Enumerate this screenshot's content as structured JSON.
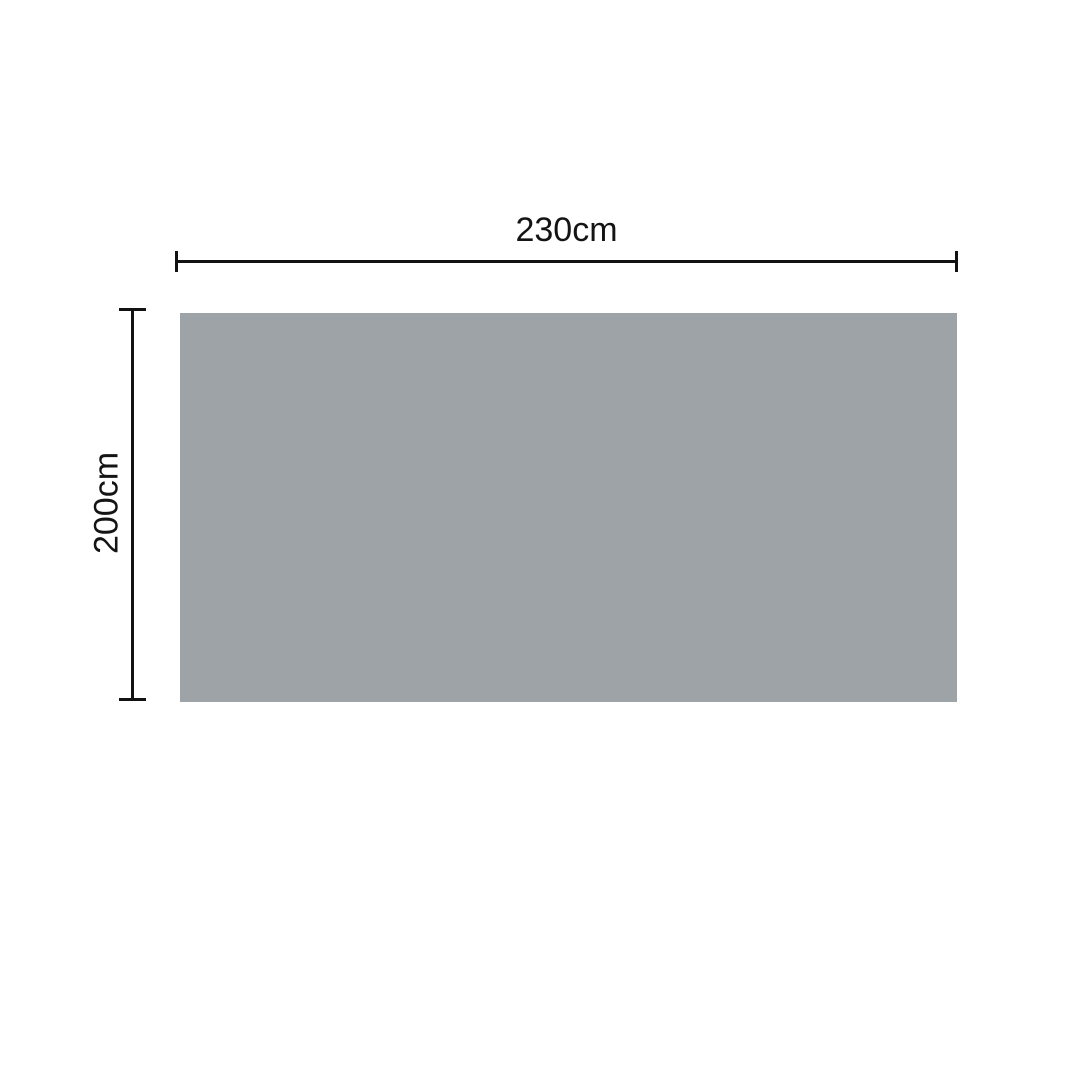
{
  "diagram": {
    "shape": "rectangle",
    "width_label": "230cm",
    "height_label": "200cm",
    "colors": {
      "panel_fill": "#9EA3A7",
      "dimension_line": "#121212",
      "label_text": "#141414",
      "background": "#FFFFFF"
    }
  }
}
